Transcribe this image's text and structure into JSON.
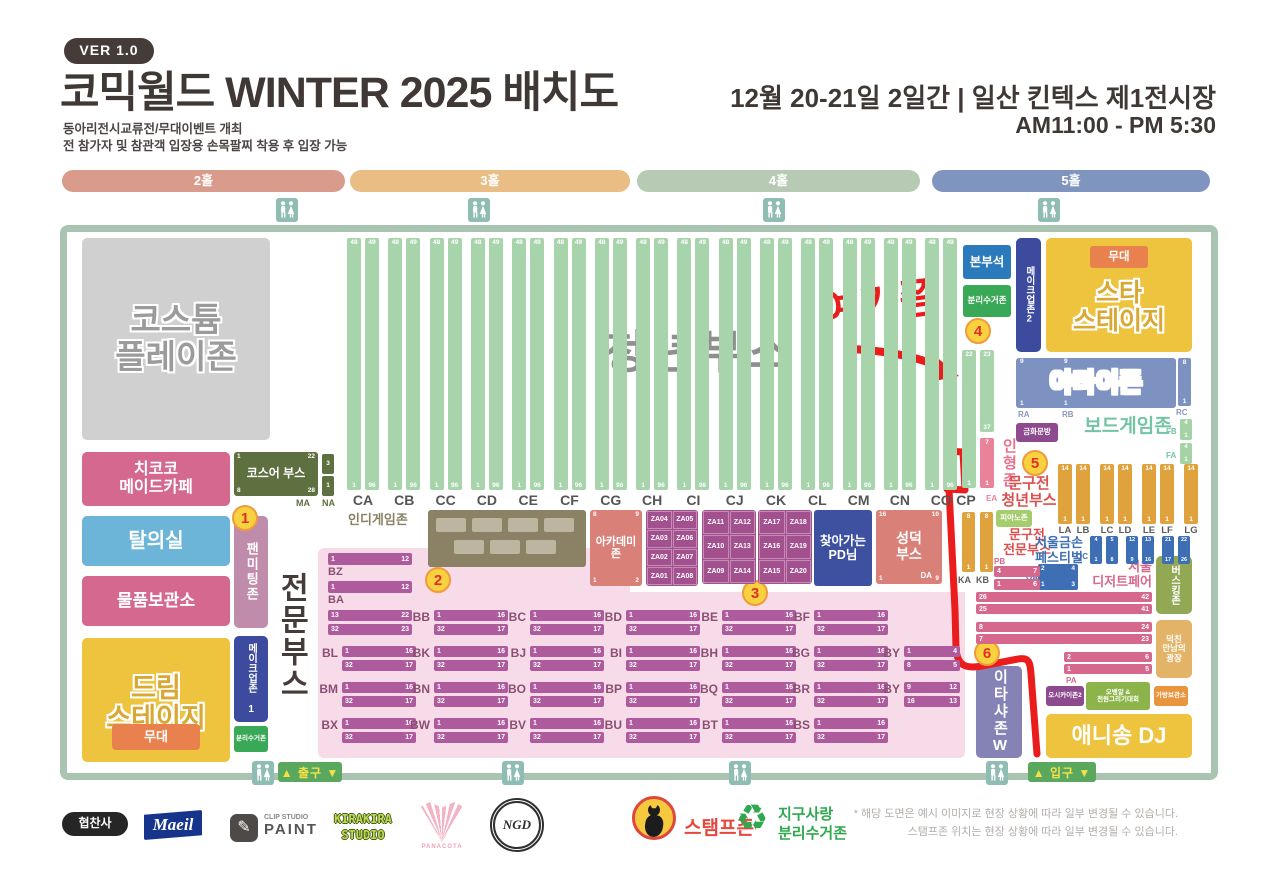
{
  "header": {
    "version": "VER 1.0",
    "title": "코믹월드 WINTER 2025 배치도",
    "subtitle1": "동아리전시교류전/무대이벤트 개최",
    "subtitle2": "전 참가자 및 참관객 입장용 손목팔찌 착용 후 입장 가능",
    "date_venue": "12월 20-21일 2일간 | 일산 킨텍스 제1전시장",
    "hours": "AM11:00 - PM 5:30"
  },
  "halls": [
    {
      "label": "2홀",
      "color": "#d89b8c"
    },
    {
      "label": "3홀",
      "color": "#e9bd84"
    },
    {
      "label": "4홀",
      "color": "#b7cbb4"
    },
    {
      "label": "5홀",
      "color": "#8094c0"
    }
  ],
  "circles": [
    "1",
    "2",
    "3",
    "4",
    "5",
    "6"
  ],
  "left": {
    "costume": "코스튬\n플레이존",
    "maid_cafe": "치코코\n메이드카페",
    "cosplayer_booth": {
      "title": "코스어 부스",
      "corners": [
        "1",
        "22",
        "8",
        "28"
      ],
      "label": "MA",
      "side_nums": [
        "3",
        "1"
      ],
      "side_label": "NA"
    },
    "fitting_room": "탈의실",
    "fan_meeting": "팬미팅존",
    "storage": "물품보관소",
    "dream_stage": "드림\n스테이지",
    "stage": "무대",
    "makeup1": "메이크업존 1",
    "recycle": "분리수거존",
    "pro_title": "전문부스"
  },
  "youth": {
    "title": "청년부스",
    "columns": [
      "CA",
      "CB",
      "CC",
      "CD",
      "CE",
      "CF",
      "CG",
      "CH",
      "CI",
      "CJ",
      "CK",
      "CL",
      "CM",
      "CN",
      "CO"
    ],
    "strip_top": [
      "48",
      "49"
    ],
    "strip_bottom": [
      "1",
      "96"
    ],
    "cp": {
      "label": "CP",
      "left_top": "22",
      "left_bottom": "1",
      "right_top": "23",
      "right_bottom": "37"
    },
    "ea": {
      "label": "EA",
      "top": "7",
      "bottom": "1"
    },
    "ka": {
      "label": "KA",
      "top": "8",
      "bottom": "1"
    },
    "kb": {
      "label": "KB",
      "top": "8",
      "bottom": "1"
    }
  },
  "mid": {
    "indie_game": "인디게임존",
    "academy": {
      "title": "아카데미\n존",
      "corners": [
        "8",
        "9",
        "1",
        "2"
      ]
    },
    "za_groups": [
      [
        [
          "ZA04",
          "ZA05"
        ],
        [
          "ZA03",
          "ZA06"
        ],
        [
          "ZA02",
          "ZA07"
        ],
        [
          "ZA01",
          "ZA08"
        ]
      ],
      [
        [
          "ZA11",
          "ZA12"
        ],
        [
          "ZA10",
          "ZA13"
        ],
        [
          "ZA09",
          "ZA14"
        ]
      ],
      [
        [
          "ZA17",
          "ZA18"
        ],
        [
          "ZA16",
          "ZA19"
        ],
        [
          "ZA15",
          "ZA20"
        ]
      ]
    ],
    "pd": "찾아가는\nPD님",
    "seongdeok": {
      "title": "성덕\n부스",
      "corners": [
        "16",
        "10",
        "1",
        "9"
      ],
      "label": "DA"
    }
  },
  "pro": {
    "bz": {
      "label": "BZ",
      "nums": [
        "1",
        "12"
      ]
    },
    "ba": {
      "label": "BA",
      "nums": [
        "1",
        "12"
      ]
    },
    "ba2": [
      [
        "13",
        "22"
      ],
      [
        "32",
        "23"
      ]
    ],
    "row_nums": [
      [
        "1",
        "16"
      ],
      [
        "32",
        "17"
      ]
    ],
    "rows": [
      [
        "BB",
        "BC",
        "BD",
        "BE",
        "BF"
      ],
      [
        "BL",
        "BK",
        "BJ",
        "BI",
        "BH",
        "BG"
      ],
      [
        "BM",
        "BN",
        "BO",
        "BP",
        "BQ",
        "BR"
      ],
      [
        "BX",
        "BW",
        "BV",
        "BU",
        "BT",
        "BS"
      ]
    ],
    "by1": {
      "label": "BY",
      "nums": [
        [
          "1",
          "4"
        ],
        [
          "8",
          "5"
        ]
      ]
    },
    "by2": {
      "label": "BY",
      "nums": [
        [
          "9",
          "12"
        ],
        [
          "16",
          "13"
        ]
      ]
    }
  },
  "right": {
    "hq": "본부석",
    "recycle": "분리수거존",
    "makeup2": "메이크업존2",
    "star_stage": "스타\n스테이지",
    "stage": "무대",
    "yatai": {
      "title": "야타이존",
      "tops": [
        "9",
        "9"
      ],
      "bottoms": [
        "1",
        "1"
      ],
      "rc_top": "8",
      "rc_bottom": "1",
      "labels": [
        "RA",
        "RB",
        "RC"
      ]
    },
    "geumhwa": "금화문방",
    "board_game": {
      "title": "보드게임존",
      "fb": "FB",
      "fa": "FA",
      "strip_top": "4",
      "strip_bottom": "1"
    },
    "doll_zone": "인형존",
    "stationery_youth": "문구전\n청년부스",
    "l_strips": {
      "labels": [
        "LA",
        "LB",
        "LC",
        "LD",
        "LE",
        "LF",
        "LG"
      ],
      "top": "14",
      "bottom": "1"
    },
    "piano": "피아노존",
    "stationery_pro": "문구전\n전문부스",
    "pb": {
      "label": "PB",
      "rows": [
        [
          "4",
          "7"
        ],
        [
          "1",
          "6"
        ]
      ]
    },
    "geumson": "서울금손\n페스티벌",
    "qa": {
      "label": "QA",
      "corners": [
        "2",
        "4",
        "1",
        "3"
      ]
    },
    "qc": {
      "label": "QC",
      "tops": [
        "4",
        "5",
        "12",
        "13",
        "21",
        "22"
      ],
      "bottoms": [
        "1",
        "8",
        "9",
        "16",
        "17",
        "26"
      ]
    },
    "dessert": {
      "title": "서울\n디저트페어",
      "rows": [
        [
          "26",
          "42"
        ],
        [
          "25",
          "41"
        ],
        [
          "8",
          "24"
        ],
        [
          "7",
          "23"
        ],
        [
          "2",
          "6"
        ],
        [
          "1",
          "5"
        ]
      ],
      "label": "PA"
    },
    "busking": "버스킹존",
    "plaza": "덕친\n만남의\n광장",
    "itasha": "이타샤존W",
    "oshikai": "오시카이존2",
    "obangal": "오뱅알 &\n천원그리기대회",
    "bag": "가방보관소",
    "anisong": "애니송 DJ"
  },
  "gates": {
    "exit": "▲ 출구 ▼",
    "entrance": "▲ 입구 ▼"
  },
  "annotation": {
    "text": "여기쯤"
  },
  "footer": {
    "sponsor_label": "협찬사",
    "maeil": "Maeil",
    "clip_top": "CLIP STUDIO",
    "clip_bottom": "PAINT",
    "kirakira": "KIRAKIRA\nSTUDIO",
    "panacota": "PANACOTA",
    "crest": "NGD",
    "stamp": "스탬프존",
    "recycle_symbol": "♻",
    "recycle_logo": "지구사랑\n분리수거존",
    "note1": "* 해당 도면은 예시 이미지로 현장 상황에 따라 일부 변경될 수 있습니다.",
    "note2": "스탬프존 위치는 현장 상황에 따라 일부 변경될 수 있습니다."
  }
}
